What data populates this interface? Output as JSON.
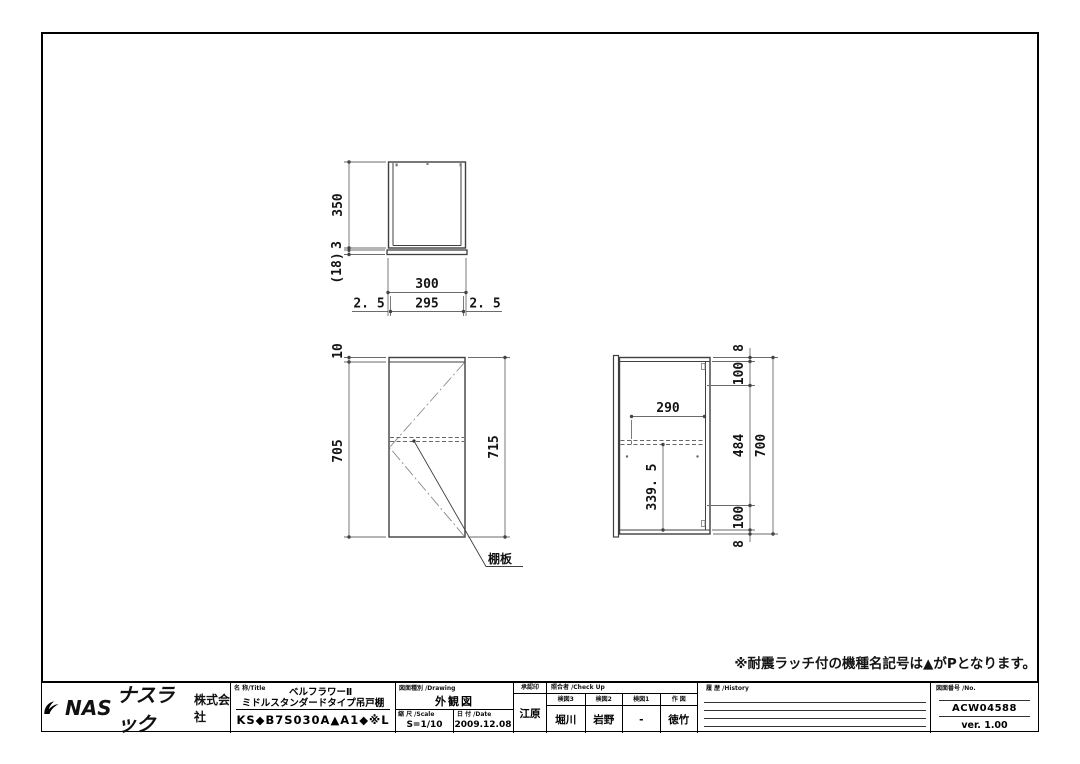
{
  "colors": {
    "object_line": "#3f3f3f",
    "dim_line": "#6b6b6b",
    "accent": "#000000"
  },
  "top_view": {
    "d350": "350",
    "d3": "3",
    "d18": "(18)",
    "d300": "300",
    "d25l": "2. 5",
    "d295": "295",
    "d25r": "2. 5"
  },
  "front_view": {
    "d10": "10",
    "d705": "705",
    "d715": "715",
    "shelf_label": "棚板"
  },
  "side_view": {
    "d290": "290",
    "d3395": "339. 5",
    "d8_top": "8",
    "d100_top": "100",
    "d484": "484",
    "d100_bottom": "100",
    "d8_bottom": "8",
    "d700": "700"
  },
  "note": "※耐震ラッチ付の機種名記号は▲がPとなります。",
  "title_block": {
    "logo": {
      "nas": "NAS",
      "kana": "ナスラック",
      "suffix": "株式会社"
    },
    "title": {
      "label": "名 称/Title",
      "line1": "ベルフラワーⅡ",
      "line2": "ミドルスタンダードタイプ吊戸棚",
      "model": "KS◆B7S030A▲A1◆※L"
    },
    "drawing": {
      "label": "図面種別 /Drawing",
      "value": "外観図",
      "scale_label": "縮 尺 /Scale",
      "scale": "S=1/10",
      "date_label": "日 付 /Date",
      "date": "2009.12.08"
    },
    "approval": {
      "label": "承認印",
      "value": "江原"
    },
    "check": {
      "label": "照合者 /Check Up",
      "cols": [
        {
          "label": "検図3",
          "value": "堀川"
        },
        {
          "label": "検図2",
          "value": "岩野"
        },
        {
          "label": "検図1",
          "value": "-"
        },
        {
          "label": "作 図",
          "value": "徳竹"
        }
      ]
    },
    "history": {
      "label": "履 歴 /History"
    },
    "number": {
      "label": "図面番号 /No.",
      "value": "ACW04588",
      "version": "ver. 1.00"
    }
  }
}
